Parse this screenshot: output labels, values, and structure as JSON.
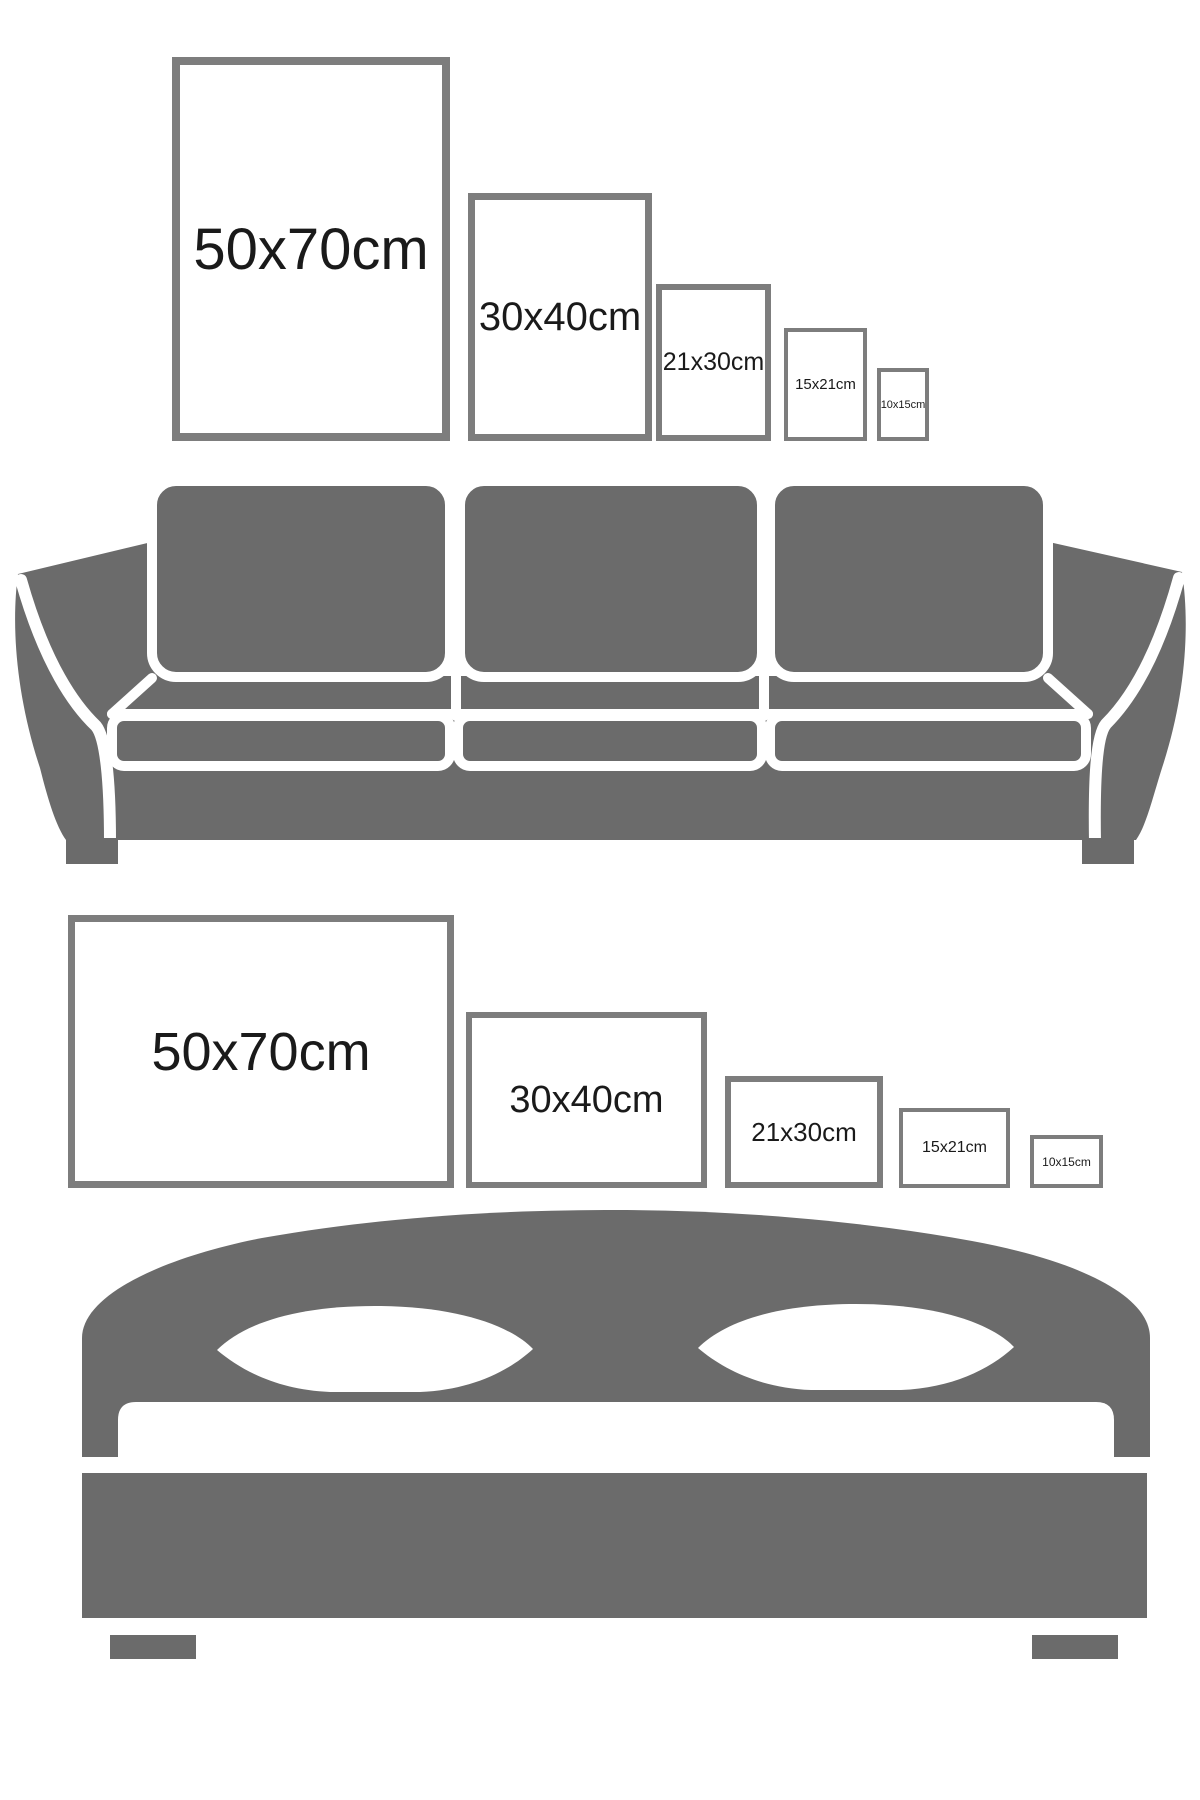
{
  "title": "Picture size comparison guide",
  "colors": {
    "furniture_gray": "#6b6b6b",
    "frame_border": "#7d7d7d",
    "label_text": "#1a1a1a",
    "background": "#ffffff"
  },
  "sections": {
    "sofa_row": {
      "furniture": "sofa",
      "orientation": "portrait",
      "frames": [
        {
          "label": "50x70cm"
        },
        {
          "label": "30x40cm"
        },
        {
          "label": "21x30cm"
        },
        {
          "label": "15x21cm"
        },
        {
          "label": "10x15cm"
        }
      ]
    },
    "bed_row": {
      "furniture": "bed",
      "orientation": "landscape",
      "frames": [
        {
          "label": "50x70cm"
        },
        {
          "label": "30x40cm"
        },
        {
          "label": "21x30cm"
        },
        {
          "label": "15x21cm"
        },
        {
          "label": "10x15cm"
        }
      ]
    }
  }
}
